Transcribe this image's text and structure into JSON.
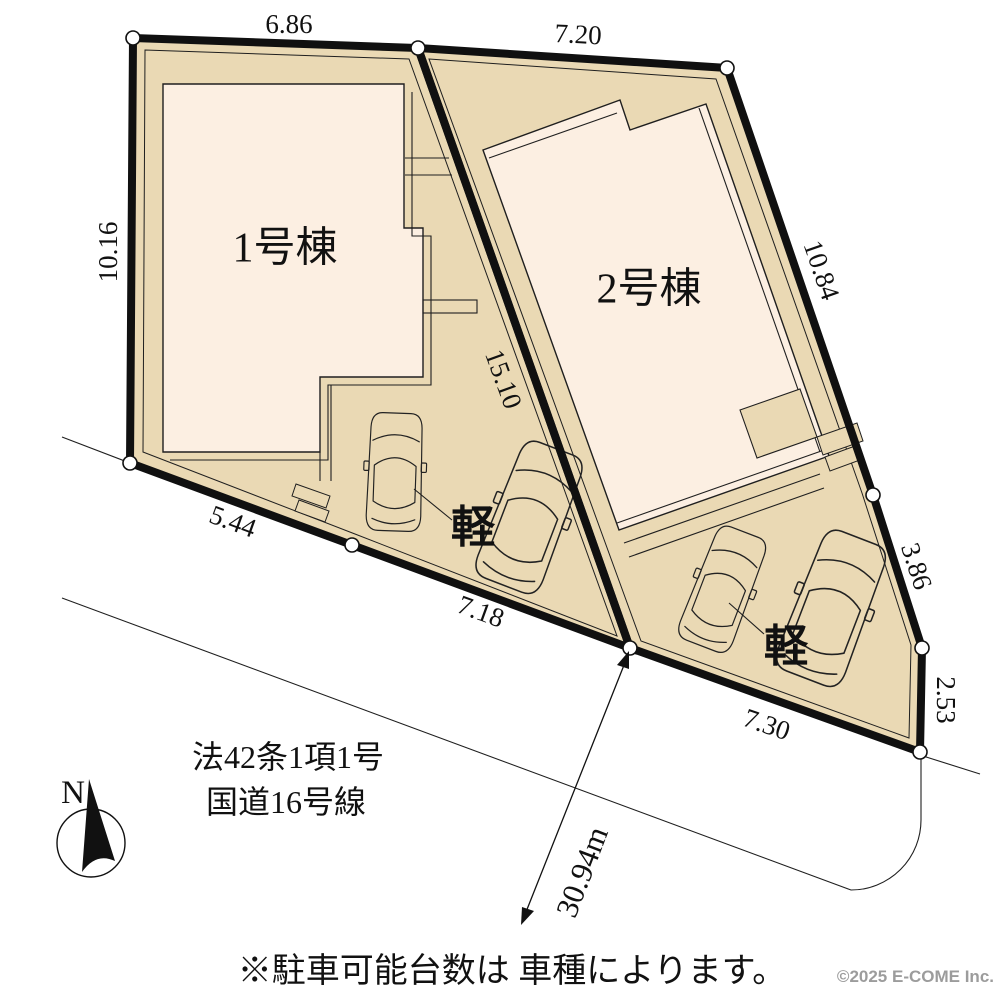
{
  "colors": {
    "plot_fill": "#ead9b4",
    "building_fill": "#fcefe2",
    "boundary": "#101010",
    "line": "#1f1f1f",
    "vertex_fill": "#ffffff",
    "copyright_gray": "#9c9c9c"
  },
  "site_plan": {
    "buildings": [
      {
        "name": "1号棟"
      },
      {
        "name": "2号棟"
      }
    ],
    "dimensions": [
      {
        "value": "6.86"
      },
      {
        "value": "7.20"
      },
      {
        "value": "10.16"
      },
      {
        "value": "10.84"
      },
      {
        "value": "15.10"
      },
      {
        "value": "5.44"
      },
      {
        "value": "7.18"
      },
      {
        "value": "7.30"
      },
      {
        "value": "3.86"
      },
      {
        "value": "2.53"
      }
    ],
    "vehicle_labels": [
      {
        "value": "軽"
      },
      {
        "value": "軽"
      }
    ],
    "frontage": {
      "line1": "法42条1項1号",
      "line2": "国道16号線"
    },
    "road_width": {
      "value": "30.94m"
    },
    "compass": {
      "label": "N"
    }
  },
  "footer": {
    "note": "※駐車可能台数は 車種によります。",
    "copyright": "©2025  E-COME Inc."
  }
}
